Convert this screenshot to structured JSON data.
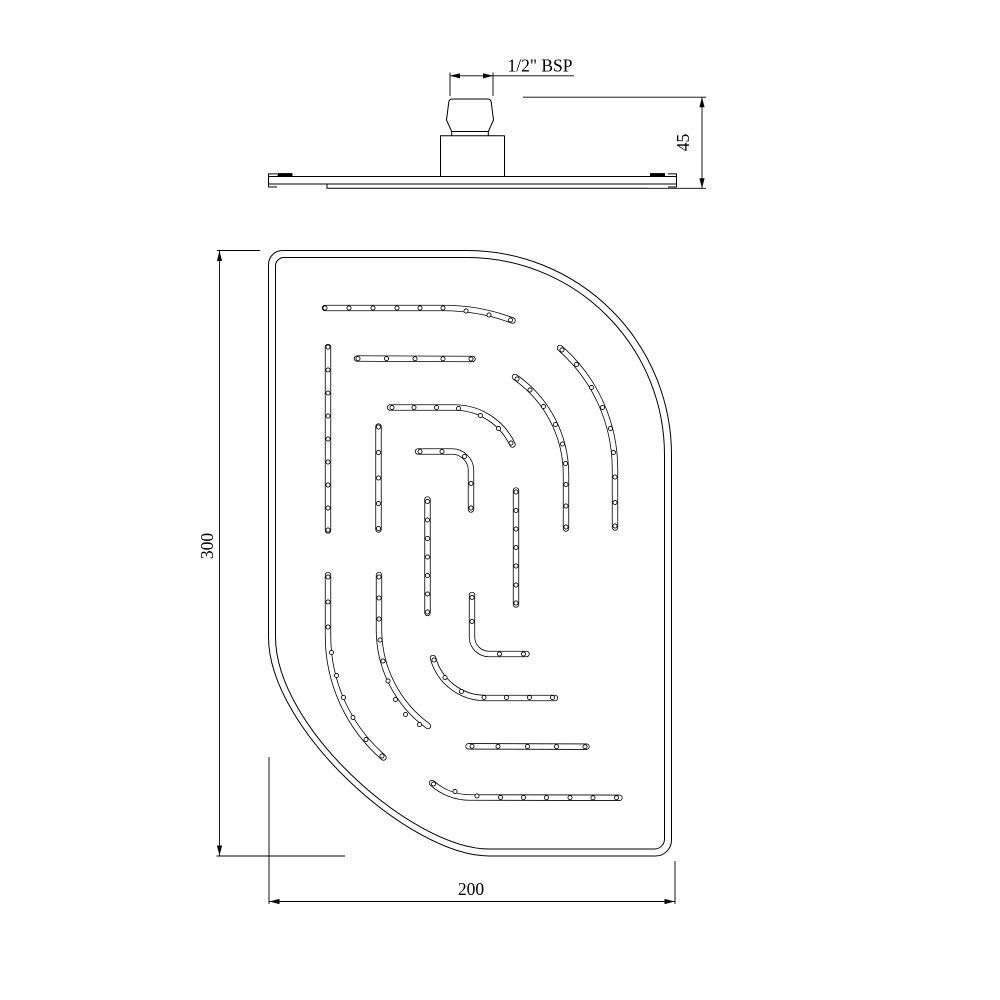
{
  "page": {
    "background_color": "#ffffff",
    "line_color": "#000000"
  },
  "side_view": {
    "thread_label": "1/2\" BSP",
    "height_dimension": "45"
  },
  "face_view": {
    "height_dimension": "300",
    "width_dimension": "200"
  }
}
